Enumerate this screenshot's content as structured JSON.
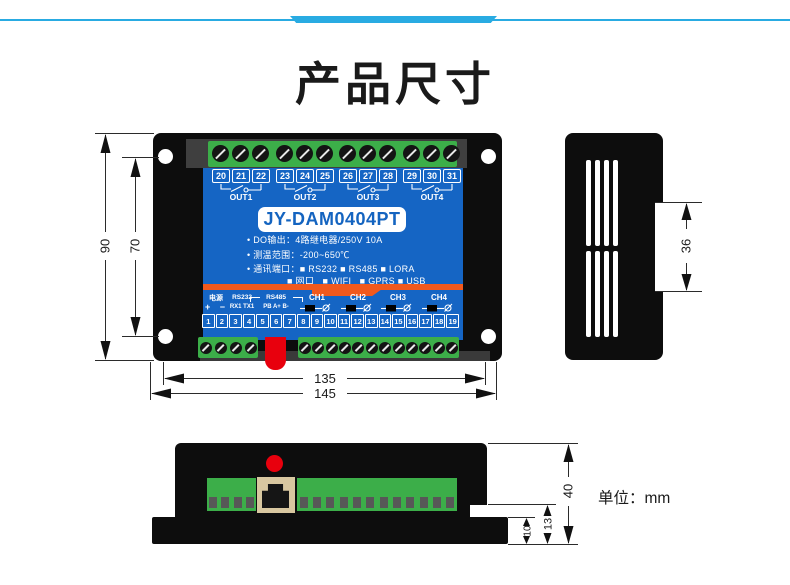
{
  "header": {
    "title": "产品尺寸"
  },
  "front_view": {
    "model": "JY-DAM0404PT",
    "top_terminal_groups": [
      [
        "20",
        "21",
        "22"
      ],
      [
        "23",
        "24",
        "25"
      ],
      [
        "26",
        "27",
        "28"
      ],
      [
        "29",
        "30",
        "31"
      ]
    ],
    "out_labels": [
      "OUT1",
      "OUT2",
      "OUT3",
      "OUT4"
    ],
    "spec_lines": [
      "• DO输出：4路继电器/250V 10A",
      "• 测温范围：-200~650℃",
      "• 通讯端口：■ RS232 ■ RS485 ■ LORA",
      "■ 网口   ■ WIFI   ■ GPRS ■ USB"
    ],
    "ports": {
      "power_label": "电源",
      "power_pins": "+ −",
      "rs232_label": "RS232",
      "rs232_pins": "RX1 TX1",
      "rs485_label": "RS485",
      "rs485_pins": "PB A+ B-",
      "channels": [
        "CH1",
        "CH2",
        "CH3",
        "CH4"
      ]
    },
    "bottom_terminals": [
      "1",
      "2",
      "3",
      "4",
      "5",
      "6",
      "7",
      "8",
      "9",
      "10",
      "11",
      "12",
      "13",
      "14",
      "15",
      "16",
      "17",
      "18",
      "19"
    ],
    "screws": {
      "per_top_group": 3,
      "bottom_left": 4,
      "bottom_right": 12
    }
  },
  "side_view": {
    "vent_columns": 4
  },
  "bottom_view": {
    "slots_left": 4,
    "slots_right": 12
  },
  "dimensions": {
    "overall_height": "90",
    "mounting_pitch": "70",
    "inner_width": "135",
    "overall_width": "145",
    "din_tab": "36",
    "overall_depth": "40",
    "step_depth": "13",
    "flange_depth": "10",
    "unit": "单位：mm"
  },
  "colors": {
    "accent_blue": "#29abe2",
    "panel_blue": "#1565c4",
    "terminal_green": "#3cae49",
    "stripe_orange": "#f1591d",
    "connector_red": "#e8000d"
  }
}
